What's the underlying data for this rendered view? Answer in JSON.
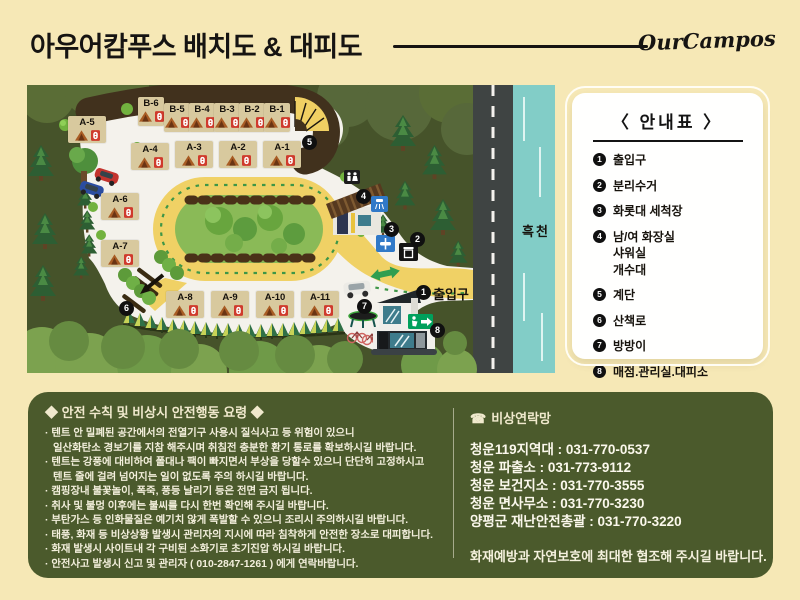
{
  "header": {
    "title": "아우어캄푸스 배치도 & 대피도",
    "brand": "OurCampos"
  },
  "map": {
    "stream_label": "흑천",
    "entrance_label": "출입구",
    "sites": [
      "B-6",
      "B-5",
      "B-4",
      "B-3",
      "B-2",
      "B-1",
      "A-5",
      "A-4",
      "A-3",
      "A-2",
      "A-1",
      "A-6",
      "A-7",
      "A-8",
      "A-9",
      "A-10",
      "A-11"
    ],
    "markers": [
      "1",
      "2",
      "3",
      "4",
      "5",
      "6",
      "7",
      "8"
    ]
  },
  "legend": {
    "title": "〈 안내표 〉",
    "items": [
      {
        "num": "1",
        "lines": [
          "출입구"
        ]
      },
      {
        "num": "2",
        "lines": [
          "분리수거"
        ]
      },
      {
        "num": "3",
        "lines": [
          "화롯대 세척장"
        ]
      },
      {
        "num": "4",
        "lines": [
          "남/여 화장실",
          "샤워실",
          "개수대"
        ]
      },
      {
        "num": "5",
        "lines": [
          "계단"
        ]
      },
      {
        "num": "6",
        "lines": [
          "산책로"
        ]
      },
      {
        "num": "7",
        "lines": [
          "방방이"
        ]
      },
      {
        "num": "8",
        "lines": [
          "매점.관리실.대피소"
        ]
      }
    ]
  },
  "safety": {
    "title": "◆ 안전 수칙 및 비상시 안전행동 요령  ◆",
    "lines": [
      {
        "t": "· 텐트 안 밀폐된 공간에서의 전열기구 사용시 질식사고 등 위험이 있으니"
      },
      {
        "t": "일산화탄소 경보기를 지참 해주시며 취침전 충분한 환기 통로를 확보하시길 바랍니다."
      },
      {
        "t": "· 텐트는 강풍에 대비하여 폴대나 팩이 빠지면서 부상을 당할수 있으니 단단히 고정하시고"
      },
      {
        "t": "텐트 줄에 걸려 넘어지는 일이 없도록 주의 하시길 바랍니다."
      },
      {
        "t": "· 캠핑장내 불꽃놀이, 폭죽, 풍등 날리기 등은 전면 금지 됩니다."
      },
      {
        "t": "· 취사 및 불멍 이후에는 불씨를 다시 한번 확인해 주시길 바랍니다."
      },
      {
        "t": "· 부탄가스 등 인화물질은 예기치 않게 폭발할 수 있으니 조리시 주의하시길 바랍니다."
      },
      {
        "t": "· 태풍, 화재 등 비상상황 발생시 관리자의 지시에 따라 침착하게 안전한 장소로 대피합니다."
      },
      {
        "t": "· 화재 발생시 사이트내 각 구비된 소화기로 초기진압 하시길 바랍니다."
      },
      {
        "t": "· 안전사고 발생시 신고 및 관리자 ( 010-2847-1261 ) 에게 연락바랍니다."
      }
    ]
  },
  "contacts": {
    "phone_icon": "☎",
    "title": "비상연락망",
    "entries": [
      "청운119지역대 : 031-770-0537",
      "청운 파출소 : 031-773-9112",
      "청운 보건지소 : 031-770-3555",
      "청운 면사무소 : 031-770-3230",
      "양평군 재난안전총괄 : 031-770-3220"
    ],
    "footer": "화재예방과 자연보호에 최대한 협조해 주시길 바랍니다."
  },
  "colors": {
    "page_bg": "#f6e8b6",
    "panel_green": "#4b5a2c",
    "forest_green": "#46532a",
    "road_yellow": "#f0d165",
    "stream_teal": "#82cdc7",
    "site_tan": "#d8c99e",
    "exit_green": "#00a05c",
    "outlet_red": "#cf3a2c"
  }
}
